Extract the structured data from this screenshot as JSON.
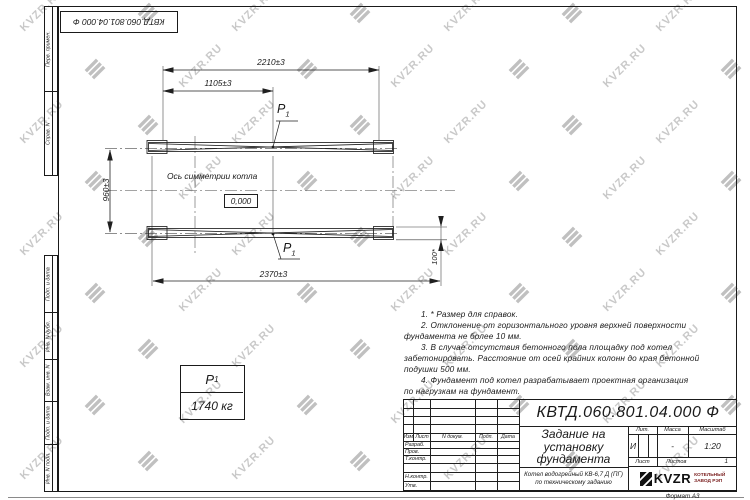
{
  "sheet": {
    "doc_number": "КВТД.060.801.04.000 Ф",
    "format_label": "Формат А3"
  },
  "margin_labels": {
    "perv_primen": "Перв. примен.",
    "sprav_n": "Справ. N",
    "podp_data_1": "Подп. и дата",
    "inv_dubl": "Инв. N дубл.",
    "vzam_inv": "Взам. инв. N",
    "podp_data_2": "Подп. и дата",
    "inv_podl": "Инв. N подл."
  },
  "drawing": {
    "dim_width_top": "2210±3",
    "dim_width_half": "1105±3",
    "dim_height": "960±3",
    "dim_width_bottom": "2370±3",
    "dim_pad": "100*",
    "axis_label": "Ось симметрии котла",
    "level_mark": "0,000",
    "load_symbol": "P",
    "load_sub": "1"
  },
  "notes": [
    "1. * Размер для справок.",
    "2. Отклонение от горизонтального уровня верхней поверхности\nфундамента не более 10 мм.",
    "3. В случае отсутствия бетонного пола площадку под котел\nзабетонировать. Расстояние от осей крайних колонн до края бетонной\nподушки 500 мм.",
    "4. Фундамент под котел разрабатывает проектная организация\nпо нагрузкам на фундамент."
  ],
  "load_table": {
    "symbol": "P",
    "sub": "1",
    "value": "1740 кг"
  },
  "title_block": {
    "doc_number": "КВТД.060.801.04.000 Ф",
    "title": "Задание на установку фундамента",
    "product_line1": "Котел водогрейный КВ-6,7 Д (ПГ)",
    "product_line2": "по техническому заданию",
    "col_izm": "Изм.",
    "col_list": "Лист",
    "col_doc": "N докум.",
    "col_podp": "Подп.",
    "col_data": "Дата",
    "rows": [
      "Разраб.",
      "Пров.",
      "Т.контр.",
      "",
      "Н.контр.",
      "Утв."
    ],
    "lit_label": "Лит.",
    "mass_label": "Масса",
    "scale_label": "Масштаб",
    "lit_value": "И",
    "mass_value": "-",
    "scale_value": "1:20",
    "sheet_label": "Лист",
    "sheets_label": "Листов",
    "sheets_value": "1",
    "company_logo": "KVZR",
    "company_line1": "КОТЕЛЬНЫЙ",
    "company_line2": "ЗАВОД РЭП"
  },
  "watermark": {
    "text": "KVZR.RU"
  },
  "colors": {
    "line": "#1f1f1f",
    "watermark": "#c9c9c9",
    "accent_red": "#7c2323"
  }
}
